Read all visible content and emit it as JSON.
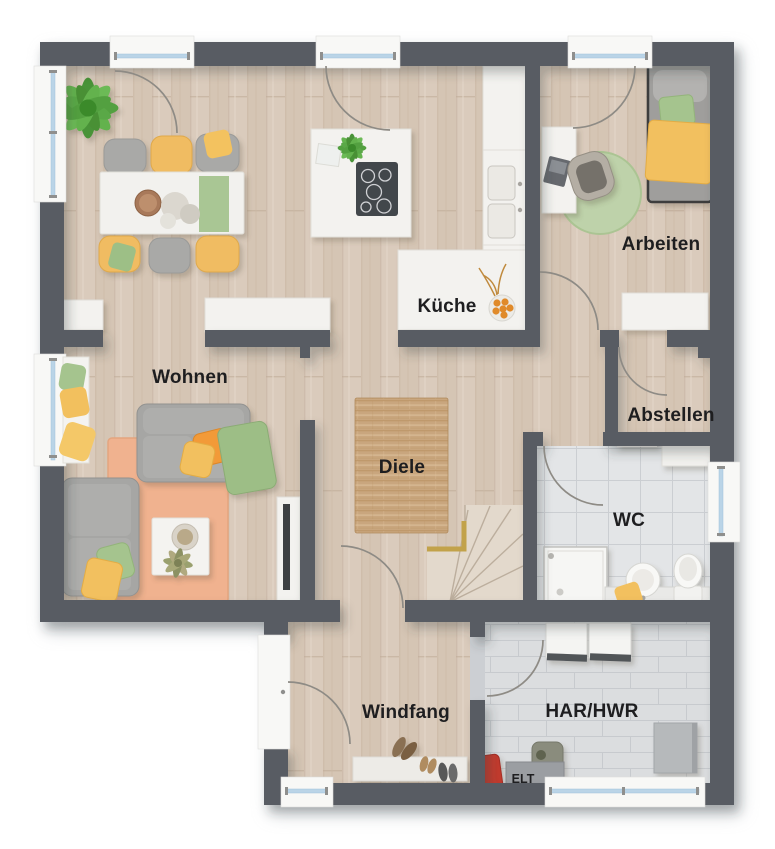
{
  "plan": {
    "title": "Erdgeschoss Grundriss",
    "rooms": {
      "kueche": {
        "label": "Küche"
      },
      "arbeiten": {
        "label": "Arbeiten"
      },
      "wohnen": {
        "label": "Wohnen"
      },
      "abstellen": {
        "label": "Abstellen"
      },
      "diele": {
        "label": "Diele"
      },
      "wc": {
        "label": "WC"
      },
      "windfang": {
        "label": "Windfang"
      },
      "hwr": {
        "label": "HAR/HWR"
      },
      "elt": {
        "label": "ELT"
      }
    },
    "colors": {
      "wall": "#585c63",
      "wood_floor": "#dacbbc",
      "wc_tile": "#e3e5e7",
      "hwr_tile": "#dbdddf",
      "rug_diele": "#c9a67e",
      "rug_wohnen": "#f0b28f",
      "rug_arbeiten": "#bed2aa",
      "accent_yellow": "#f2c05e",
      "accent_green": "#a5c48e",
      "accent_orange": "#f29a38",
      "stair_rail_gold": "#c2a24a",
      "label_text": "#1e1e20"
    }
  }
}
